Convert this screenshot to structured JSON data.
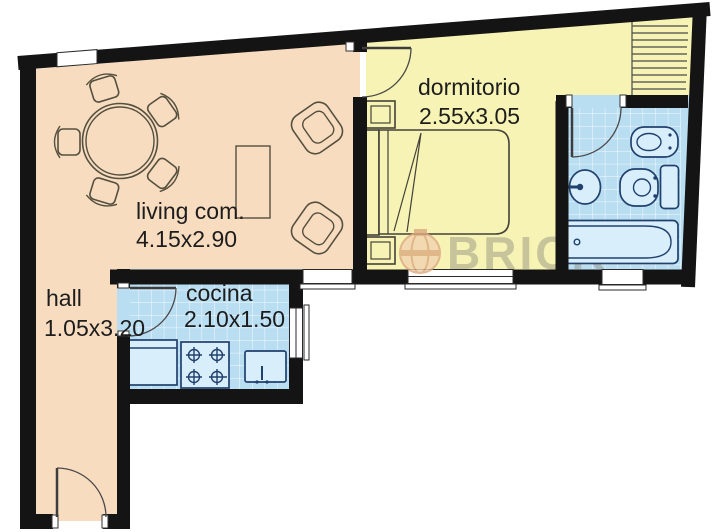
{
  "rooms": {
    "living": {
      "label": "living com.",
      "dims": "4.15x2.90"
    },
    "dormitorio": {
      "label": "dormitorio",
      "dims": "2.55x3.05"
    },
    "hall": {
      "label": "hall",
      "dims": "1.05x3.20"
    },
    "cocina": {
      "label": "cocina",
      "dims": "2.10x1.50"
    }
  },
  "watermark": {
    "brand": "BRICK"
  },
  "colors": {
    "wall": "#141414",
    "living_hall_floor": "#f8dcc0",
    "bedroom_floor": "#f6f3b4",
    "wet_room_floor": "#b9ddf1",
    "fixture_outline": "#20406e",
    "watermark_text": "#8f8d7e",
    "watermark_logo": "#dba97e"
  }
}
